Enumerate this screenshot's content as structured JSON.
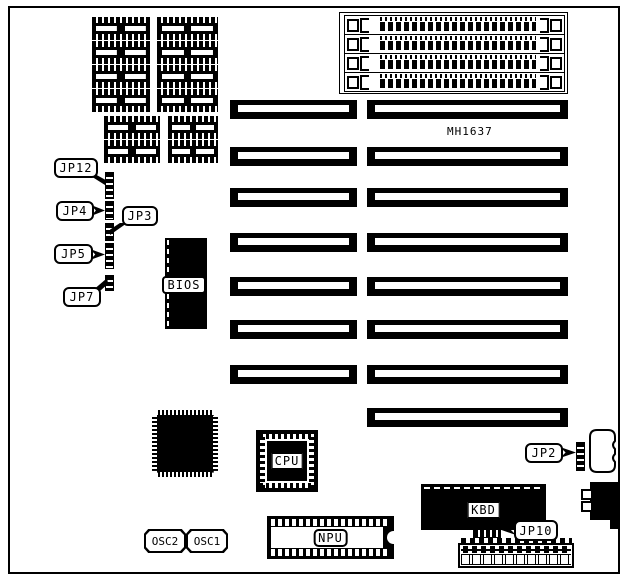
{
  "diagram": {
    "type": "motherboard-layout",
    "model": "MH1637",
    "ink_color": "#000000",
    "paper_color": "#ffffff"
  },
  "chips": {
    "bios": "BIOS",
    "cpu": "CPU",
    "npu": "NPU",
    "kbd": "KBD",
    "osc2": "OSC2",
    "osc1": "OSC1"
  },
  "jumpers": {
    "jp12": "JP12",
    "jp4": "JP4",
    "jp3": "JP3",
    "jp5": "JP5",
    "jp7": "JP7",
    "jp2": "JP2",
    "jp10": "JP10"
  },
  "counts": {
    "dram_sockets": 12,
    "simm_slots": 4,
    "expansion_slot_pairs": 7,
    "expansion_slots_right_only": 1
  }
}
